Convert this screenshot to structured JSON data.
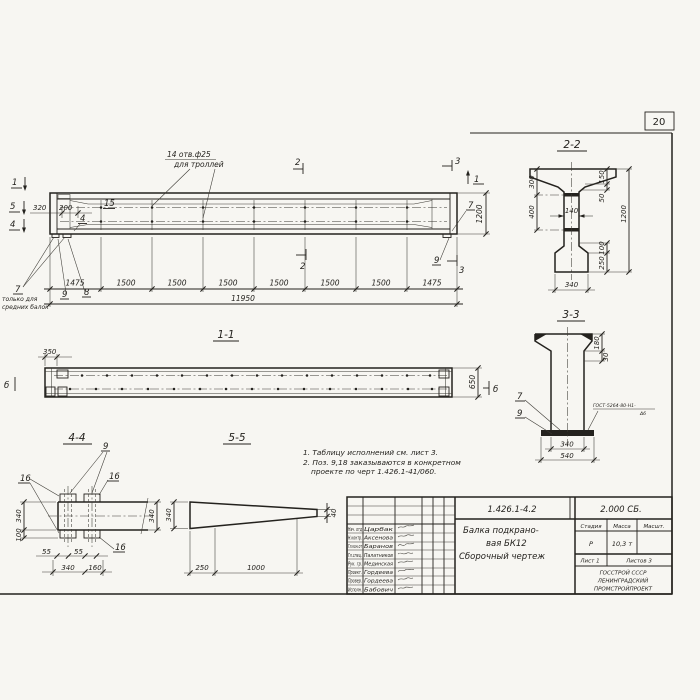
{
  "page_number": "20",
  "main_view": {
    "holes_note_line1": "14 отв.ф25",
    "holes_note_line2": "для троллей",
    "mark_1_left": "1",
    "mark_5_left": "5",
    "mark_4_left": "4",
    "mark_2_top": "2",
    "mark_2_bottom": "2",
    "mark_3_top": "3",
    "mark_3_bottom": "3",
    "mark_1_right": "1",
    "dim_320": "320",
    "dim_200": "200",
    "pos_15": "15",
    "pos_4": "4",
    "pos_7_left": "7",
    "pos_7_note_line1": "только для",
    "pos_7_note_line2": "средних балок",
    "pos_9_left": "9",
    "pos_8": "8",
    "pos_7_right": "7",
    "pos_9_right": "9",
    "dim_height_1200": "1200",
    "segments": [
      "1475",
      "1500",
      "1500",
      "1500",
      "1500",
      "1500",
      "1500",
      "1475"
    ],
    "dim_total": "11950"
  },
  "section_1_1": {
    "title": "1-1",
    "dim_350": "350",
    "dim_650": "650",
    "mark_6_left": "б",
    "mark_6_right": "б"
  },
  "section_2_2": {
    "title": "2-2",
    "dim_300": "300",
    "dim_400": "400",
    "dim_140": "140",
    "dim_150": "150",
    "dim_50": "50",
    "dim_1200": "1200",
    "dim_100": "100",
    "dim_250": "250",
    "dim_340": "340"
  },
  "section_3_3": {
    "title": "3-3",
    "dim_180": "180",
    "dim_30": "30",
    "pos_7": "7",
    "pos_9": "9",
    "weld_note_line1": "ГОСТ-5264-80-Н1-",
    "weld_note_line2": "Δ6",
    "dim_340": "340",
    "dim_540": "540"
  },
  "section_4_4": {
    "title": "4-4",
    "pos_9": "9",
    "pos_16_left": "16",
    "pos_16_right": "16",
    "pos_16_bottom": "16",
    "dim_340_left": "340",
    "dim_100": "100",
    "dim_340_right": "340",
    "dim_55_a": "55",
    "dim_55_b": "55",
    "dim_340_bottom": "340",
    "dim_160": "160"
  },
  "section_5_5": {
    "title": "5-5",
    "dim_340": "340",
    "dim_40": "40",
    "dim_250": "250",
    "dim_1000": "1000"
  },
  "notes": {
    "line1": "1. Таблицу исполнений см. лист 3.",
    "line2": "2. Поз. 9,18 заказываются в конкретном",
    "line3": "проекте по черт 1.426.1-41/060."
  },
  "title_block": {
    "doc_number": "1.426.1-4.2",
    "doc_code": "2.000 СБ.",
    "product_line1": "Балка подкрано-",
    "product_line2": "вая БК12",
    "product_line3": "Сборочный чертеж",
    "col_stage": "Стадия",
    "col_mass": "Масса",
    "col_scale": "Масшт.",
    "stage_value": "Р",
    "mass_value": "10,3 т",
    "sheet_info": "Лист 1",
    "sheets_info": "Листов 3",
    "org_line1": "ГОССТРОЙ СССР",
    "org_line2": "ЛЕНИНГРАДСКИЙ",
    "org_line3": "ПРОМСТРОЙПРОЕКТ",
    "rows": [
      {
        "role": "Нач. отд",
        "name": "Царбак"
      },
      {
        "role": "Н.контр.",
        "name": "Аксенова"
      },
      {
        "role": "Гл.кон.от",
        "name": "Баранов"
      },
      {
        "role": "Гл.спец.",
        "name": "Палатников"
      },
      {
        "role": "Рук. гр.",
        "name": "Мединская"
      },
      {
        "role": "Проект.",
        "name": "Гордеева"
      },
      {
        "role": "Провер.",
        "name": "Гордеева"
      },
      {
        "role": "Исполн.",
        "name": "Бабович"
      }
    ]
  }
}
